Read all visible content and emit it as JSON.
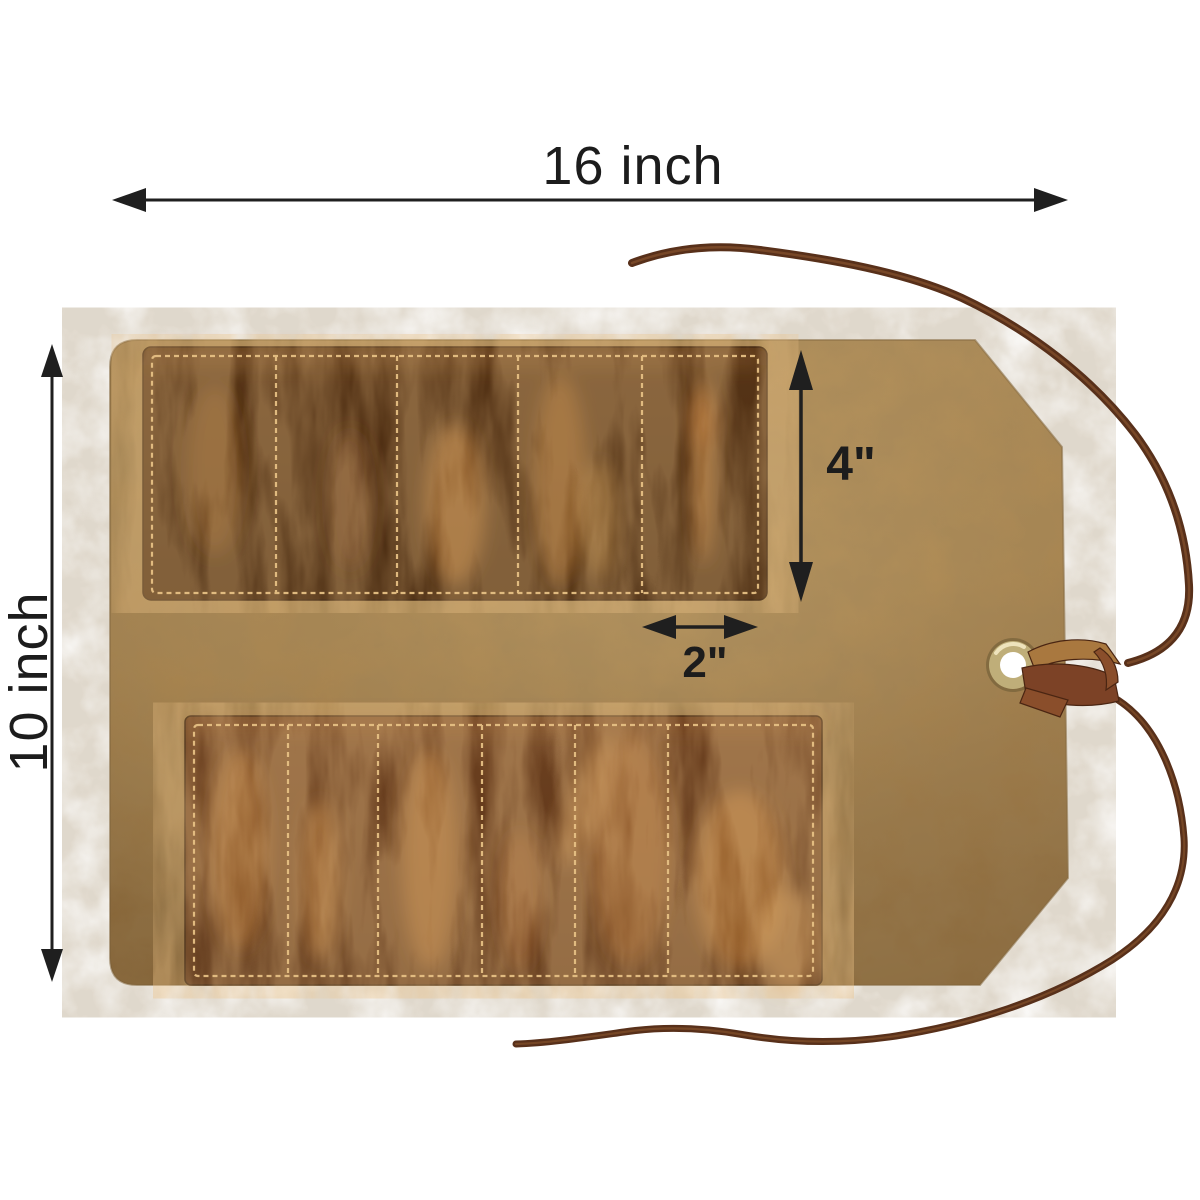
{
  "product": {
    "type": "leather tool roll (rolled pouch, flat view)",
    "top_row_pockets": 5,
    "bottom_row_pockets": 6,
    "closure": "leather lace tie through brass grommet"
  },
  "dimensions": {
    "overall_width": {
      "label": "16 inch",
      "value": 16,
      "unit": "inch"
    },
    "overall_height": {
      "label": "10 inch",
      "value": 10,
      "unit": "inch"
    },
    "pocket_height": {
      "label": "4\"",
      "value": 4,
      "unit": "inch"
    },
    "pocket_width": {
      "label": "2\"",
      "value": 2,
      "unit": "inch"
    }
  },
  "colors": {
    "background": "#ffffff",
    "dimension_line": "#1f1f1f",
    "label_text": "#1c1c1c",
    "leather_light": "#b3905a",
    "leather_base": "#a6814b",
    "leather_dark": "#8a6739",
    "pocket_top": "#573517",
    "pocket_top_dark": "#47290f",
    "pocket_bottom": "#6d4120",
    "pocket_bottom_dark": "#5a3317",
    "stitch": "#e6c084",
    "lace": "#58301a",
    "lace_highlight": "#7f4e2a",
    "knot_light": "#a9783f",
    "knot_mid": "#8a4e2b",
    "knot_dark": "#7c4226",
    "grommet": "#bfae79",
    "grommet_hole": "#ffffff"
  }
}
